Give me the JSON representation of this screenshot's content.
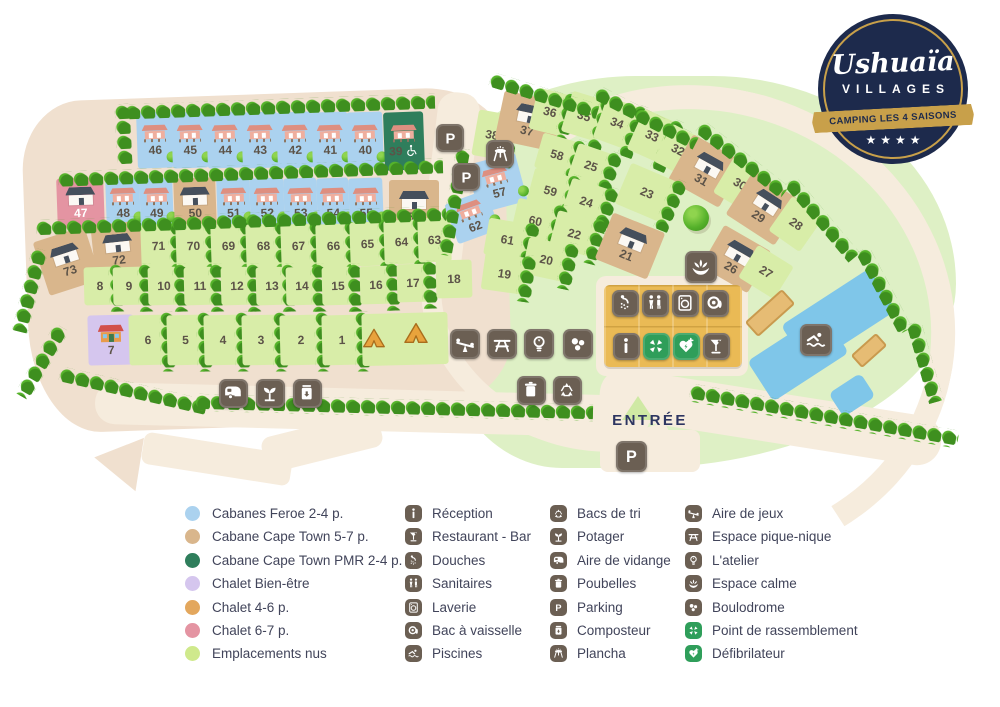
{
  "logo": {
    "brand": "Ushuaïa",
    "sub": "VILLAGES",
    "banner": "CAMPING LES 4 SAISONS",
    "stars": "★★★★"
  },
  "map": {
    "entrance_label": "ENTRÉE",
    "pitches": [
      {
        "n": "46",
        "x": 137,
        "y": 112,
        "w": 36,
        "h": 56,
        "r": -2,
        "t": "b",
        "c": "s"
      },
      {
        "n": "45",
        "x": 172,
        "y": 112,
        "w": 36,
        "h": 56,
        "r": -2,
        "t": "b",
        "c": "s"
      },
      {
        "n": "44",
        "x": 207,
        "y": 112,
        "w": 36,
        "h": 56,
        "r": -2,
        "t": "b",
        "c": "s"
      },
      {
        "n": "43",
        "x": 242,
        "y": 112,
        "w": 36,
        "h": 56,
        "r": -2,
        "t": "b",
        "c": "s"
      },
      {
        "n": "42",
        "x": 277,
        "y": 112,
        "w": 36,
        "h": 56,
        "r": -2,
        "t": "b",
        "c": "s"
      },
      {
        "n": "41",
        "x": 312,
        "y": 112,
        "w": 36,
        "h": 56,
        "r": -2,
        "t": "b",
        "c": "s"
      },
      {
        "n": "40",
        "x": 347,
        "y": 112,
        "w": 36,
        "h": 56,
        "r": -2,
        "t": "b",
        "c": "s"
      },
      {
        "n": "39",
        "x": 384,
        "y": 112,
        "w": 40,
        "h": 58,
        "r": -2,
        "t": "d",
        "c": "s",
        "pw": true
      },
      {
        "n": "47",
        "x": 57,
        "y": 178,
        "w": 47,
        "h": 50,
        "r": -2,
        "t": "p",
        "c": "h",
        "wl": true
      },
      {
        "n": "48",
        "x": 106,
        "y": 178,
        "w": 34,
        "h": 50,
        "r": -2,
        "t": "b",
        "c": "s"
      },
      {
        "n": "49",
        "x": 140,
        "y": 178,
        "w": 33,
        "h": 50,
        "r": -2,
        "t": "b",
        "c": "s"
      },
      {
        "n": "50",
        "x": 174,
        "y": 178,
        "w": 42,
        "h": 50,
        "r": -2,
        "t": "t",
        "c": "h"
      },
      {
        "n": "51",
        "x": 217,
        "y": 178,
        "w": 33,
        "h": 50,
        "r": -2,
        "t": "b",
        "c": "s"
      },
      {
        "n": "52",
        "x": 250,
        "y": 178,
        "w": 34,
        "h": 50,
        "r": -2,
        "t": "b",
        "c": "s"
      },
      {
        "n": "53",
        "x": 284,
        "y": 178,
        "w": 33,
        "h": 50,
        "r": -2,
        "t": "b",
        "c": "s"
      },
      {
        "n": "54",
        "x": 317,
        "y": 178,
        "w": 32,
        "h": 50,
        "r": -2,
        "t": "b",
        "c": "s"
      },
      {
        "n": "55",
        "x": 349,
        "y": 178,
        "w": 34,
        "h": 50,
        "r": -2,
        "t": "b",
        "c": "s"
      },
      {
        "n": "56",
        "x": 389,
        "y": 180,
        "w": 50,
        "h": 54,
        "r": 0,
        "t": "t",
        "c": "h"
      },
      {
        "n": "57",
        "x": 472,
        "y": 158,
        "w": 50,
        "h": 50,
        "r": -15,
        "t": "b",
        "c": "s"
      },
      {
        "n": "62",
        "x": 450,
        "y": 196,
        "w": 44,
        "h": 42,
        "r": -20,
        "t": "b",
        "c": "s"
      },
      {
        "n": "73",
        "x": 40,
        "y": 233,
        "w": 54,
        "h": 56,
        "r": -18,
        "t": "t",
        "c": "h"
      },
      {
        "n": "72",
        "x": 93,
        "y": 223,
        "w": 50,
        "h": 54,
        "r": -6,
        "t": "t",
        "c": "h"
      },
      {
        "n": "71",
        "x": 141,
        "y": 224,
        "w": 35,
        "h": 44,
        "r": -2,
        "t": "g",
        "s": true
      },
      {
        "n": "70",
        "x": 176,
        "y": 224,
        "w": 35,
        "h": 44,
        "r": -2,
        "t": "g",
        "s": true
      },
      {
        "n": "69",
        "x": 211,
        "y": 224,
        "w": 35,
        "h": 44,
        "r": -2,
        "t": "g",
        "s": true
      },
      {
        "n": "68",
        "x": 246,
        "y": 224,
        "w": 35,
        "h": 44,
        "r": -2,
        "t": "g",
        "s": true
      },
      {
        "n": "67",
        "x": 281,
        "y": 224,
        "w": 35,
        "h": 44,
        "r": -2,
        "t": "g",
        "s": true
      },
      {
        "n": "66",
        "x": 316,
        "y": 224,
        "w": 35,
        "h": 44,
        "r": -2,
        "t": "g",
        "s": true
      },
      {
        "n": "65",
        "x": 350,
        "y": 222,
        "w": 35,
        "h": 44,
        "r": -2,
        "t": "g",
        "s": true
      },
      {
        "n": "64",
        "x": 384,
        "y": 220,
        "w": 35,
        "h": 44,
        "r": -2,
        "t": "g",
        "s": true
      },
      {
        "n": "63",
        "x": 418,
        "y": 218,
        "w": 33,
        "h": 44,
        "r": -2,
        "t": "g"
      },
      {
        "n": "8",
        "x": 84,
        "y": 267,
        "w": 32,
        "h": 38,
        "r": -1.5,
        "t": "g",
        "s": true
      },
      {
        "n": "9",
        "x": 113,
        "y": 267,
        "w": 32,
        "h": 38,
        "r": -1.5,
        "t": "g",
        "s": true
      },
      {
        "n": "10",
        "x": 148,
        "y": 267,
        "w": 32,
        "h": 38,
        "r": -1.5,
        "t": "g",
        "s": true
      },
      {
        "n": "11",
        "x": 184,
        "y": 267,
        "w": 32,
        "h": 38,
        "r": -1.5,
        "t": "g",
        "s": true
      },
      {
        "n": "12",
        "x": 221,
        "y": 267,
        "w": 32,
        "h": 38,
        "r": -1.5,
        "t": "g",
        "s": true
      },
      {
        "n": "13",
        "x": 256,
        "y": 267,
        "w": 32,
        "h": 38,
        "r": -1.5,
        "t": "g",
        "s": true
      },
      {
        "n": "14",
        "x": 286,
        "y": 267,
        "w": 32,
        "h": 38,
        "r": -1.5,
        "t": "g",
        "s": true
      },
      {
        "n": "15",
        "x": 322,
        "y": 267,
        "w": 32,
        "h": 38,
        "r": -1.5,
        "t": "g",
        "s": true
      },
      {
        "n": "16",
        "x": 360,
        "y": 266,
        "w": 32,
        "h": 38,
        "r": -1.5,
        "t": "g",
        "s": true
      },
      {
        "n": "17",
        "x": 397,
        "y": 264,
        "w": 32,
        "h": 38,
        "r": -1.5,
        "t": "g",
        "s": true
      },
      {
        "n": "18",
        "x": 436,
        "y": 260,
        "w": 36,
        "h": 38,
        "r": -1.5,
        "t": "g"
      },
      {
        "n": "7",
        "x": 88,
        "y": 315,
        "w": 46,
        "h": 50,
        "r": -1.5,
        "t": "v",
        "c": "c"
      },
      {
        "n": "6",
        "x": 129,
        "y": 315,
        "w": 38,
        "h": 50,
        "r": -1.5,
        "t": "g",
        "s": true
      },
      {
        "n": "5",
        "x": 167,
        "y": 315,
        "w": 37,
        "h": 50,
        "r": -1.5,
        "t": "g",
        "s": true
      },
      {
        "n": "4",
        "x": 204,
        "y": 315,
        "w": 38,
        "h": 50,
        "r": -1.5,
        "t": "g",
        "s": true
      },
      {
        "n": "3",
        "x": 242,
        "y": 315,
        "w": 38,
        "h": 50,
        "r": -1.5,
        "t": "g",
        "s": true
      },
      {
        "n": "2",
        "x": 280,
        "y": 315,
        "w": 42,
        "h": 50,
        "r": -1.5,
        "t": "g",
        "s": true
      },
      {
        "n": "1",
        "x": 322,
        "y": 315,
        "w": 40,
        "h": 50,
        "r": -1.5,
        "t": "g",
        "s": true
      },
      {
        "n": "",
        "x": 362,
        "y": 313,
        "w": 86,
        "h": 52,
        "r": -1.5,
        "t": "g"
      },
      {
        "n": "38",
        "x": 475,
        "y": 112,
        "w": 34,
        "h": 46,
        "r": 10,
        "t": "g",
        "s": true
      },
      {
        "n": "37",
        "x": 499,
        "y": 96,
        "w": 60,
        "h": 50,
        "r": 12,
        "t": "t",
        "c": "h"
      },
      {
        "n": "36",
        "x": 533,
        "y": 91,
        "w": 34,
        "h": 42,
        "r": 14,
        "t": "g",
        "s": true
      },
      {
        "n": "35",
        "x": 566,
        "y": 95,
        "w": 36,
        "h": 42,
        "r": 17,
        "t": "g",
        "s": true
      },
      {
        "n": "34",
        "x": 599,
        "y": 101,
        "w": 36,
        "h": 44,
        "r": 20,
        "t": "g",
        "s": true
      },
      {
        "n": "33",
        "x": 634,
        "y": 114,
        "w": 36,
        "h": 44,
        "r": 24,
        "t": "g",
        "s": true
      },
      {
        "n": "32",
        "x": 661,
        "y": 129,
        "w": 34,
        "h": 42,
        "r": 27,
        "t": "g"
      },
      {
        "n": "31",
        "x": 677,
        "y": 145,
        "w": 58,
        "h": 52,
        "r": 29,
        "t": "t",
        "c": "h"
      },
      {
        "n": "30",
        "x": 721,
        "y": 163,
        "w": 38,
        "h": 42,
        "r": 31,
        "t": "g"
      },
      {
        "n": "29",
        "x": 735,
        "y": 182,
        "w": 58,
        "h": 52,
        "r": 33,
        "t": "t",
        "c": "h"
      },
      {
        "n": "28",
        "x": 777,
        "y": 203,
        "w": 38,
        "h": 42,
        "r": 35,
        "t": "g"
      },
      {
        "n": "58",
        "x": 538,
        "y": 137,
        "w": 38,
        "h": 36,
        "r": 16,
        "t": "g",
        "s": true
      },
      {
        "n": "25",
        "x": 572,
        "y": 148,
        "w": 38,
        "h": 36,
        "r": 19,
        "t": "g",
        "s": true
      },
      {
        "n": "59",
        "x": 530,
        "y": 172,
        "w": 41,
        "h": 37,
        "r": 15,
        "t": "g",
        "s": true
      },
      {
        "n": "24",
        "x": 566,
        "y": 183,
        "w": 41,
        "h": 37,
        "r": 18,
        "t": "g",
        "s": true
      },
      {
        "n": "23",
        "x": 621,
        "y": 171,
        "w": 52,
        "h": 44,
        "r": 23,
        "t": "g",
        "s": true
      },
      {
        "n": "60",
        "x": 514,
        "y": 202,
        "w": 43,
        "h": 37,
        "r": 13,
        "t": "g",
        "s": true
      },
      {
        "n": "22",
        "x": 553,
        "y": 215,
        "w": 43,
        "h": 37,
        "r": 15,
        "t": "g",
        "s": true
      },
      {
        "n": "61",
        "x": 486,
        "y": 221,
        "w": 43,
        "h": 37,
        "r": 10,
        "t": "g",
        "s": true
      },
      {
        "n": "20",
        "x": 525,
        "y": 241,
        "w": 43,
        "h": 37,
        "r": 12,
        "t": "g",
        "s": true
      },
      {
        "n": "19",
        "x": 483,
        "y": 255,
        "w": 43,
        "h": 37,
        "r": 8,
        "t": "g",
        "s": true
      },
      {
        "n": "21",
        "x": 602,
        "y": 221,
        "w": 56,
        "h": 50,
        "r": 22,
        "t": "t",
        "c": "h"
      },
      {
        "n": "26",
        "x": 709,
        "y": 235,
        "w": 54,
        "h": 48,
        "r": 30,
        "t": "t",
        "c": "h"
      },
      {
        "n": "27",
        "x": 745,
        "y": 253,
        "w": 42,
        "h": 38,
        "r": 32,
        "t": "g"
      }
    ],
    "icons": [
      {
        "i": "parking",
        "x": 450,
        "y": 138,
        "s": 28
      },
      {
        "i": "parking",
        "x": 466,
        "y": 177,
        "s": 28
      },
      {
        "i": "grill",
        "x": 500,
        "y": 154,
        "s": 28
      },
      {
        "i": "shower",
        "x": 625,
        "y": 303,
        "s": 27
      },
      {
        "i": "wc",
        "x": 655,
        "y": 303,
        "s": 27
      },
      {
        "i": "laundry",
        "x": 685,
        "y": 303,
        "s": 27
      },
      {
        "i": "dishes",
        "x": 715,
        "y": 303,
        "s": 27
      },
      {
        "i": "info",
        "x": 626,
        "y": 346,
        "s": 27
      },
      {
        "i": "assembly",
        "x": 656,
        "y": 346,
        "s": 27,
        "green": true
      },
      {
        "i": "defib",
        "x": 686,
        "y": 346,
        "s": 27,
        "green": true
      },
      {
        "i": "cocktail",
        "x": 716,
        "y": 346,
        "s": 27
      },
      {
        "i": "lotus",
        "x": 701,
        "y": 267,
        "s": 32
      },
      {
        "i": "swim",
        "x": 816,
        "y": 340,
        "s": 32
      },
      {
        "i": "seesaw",
        "x": 465,
        "y": 344,
        "s": 30
      },
      {
        "i": "picnic",
        "x": 502,
        "y": 344,
        "s": 30
      },
      {
        "i": "bulb",
        "x": 539,
        "y": 344,
        "s": 30
      },
      {
        "i": "boules",
        "x": 578,
        "y": 344,
        "s": 30
      },
      {
        "i": "trash",
        "x": 531,
        "y": 390,
        "s": 29
      },
      {
        "i": "recycle",
        "x": 567,
        "y": 390,
        "s": 29
      },
      {
        "i": "caravan",
        "x": 233,
        "y": 393,
        "s": 29
      },
      {
        "i": "sprout",
        "x": 270,
        "y": 393,
        "s": 29
      },
      {
        "i": "compost",
        "x": 307,
        "y": 393,
        "s": 29
      },
      {
        "i": "parking",
        "x": 631,
        "y": 456,
        "s": 31
      },
      {
        "i": "tent",
        "x": 374,
        "y": 338,
        "s": 26,
        "plain": true
      },
      {
        "i": "tent",
        "x": 416,
        "y": 333,
        "s": 28,
        "plain": true
      }
    ]
  },
  "legend": {
    "plots": [
      {
        "label": "Cabanes Feroe 2-4 p.",
        "color": "#abd2ef"
      },
      {
        "label": "Cabane Cape Town 5-7 p.",
        "color": "#d9b68c"
      },
      {
        "label": "Cabane Cape Town PMR 2-4 p.",
        "color": "#2f7e5c"
      },
      {
        "label": "Chalet Bien-être",
        "color": "#d5c6ee"
      },
      {
        "label": "Chalet 4-6 p.",
        "color": "#e3a75d"
      },
      {
        "label": "Chalet 6-7 p.",
        "color": "#e494a2"
      },
      {
        "label": "Emplacements nus",
        "color": "#cfe98c"
      }
    ],
    "facilities": [
      [
        {
          "icon": "info",
          "label": "Réception"
        },
        {
          "icon": "cocktail",
          "label": "Restaurant - Bar"
        },
        {
          "icon": "shower",
          "label": "Douches"
        },
        {
          "icon": "wc",
          "label": "Sanitaires"
        },
        {
          "icon": "laundry",
          "label": "Laverie"
        },
        {
          "icon": "dishes",
          "label": "Bac à vaisselle"
        },
        {
          "icon": "swim",
          "label": "Piscines"
        }
      ],
      [
        {
          "icon": "recycle",
          "label": "Bacs de tri"
        },
        {
          "icon": "sprout",
          "label": "Potager"
        },
        {
          "icon": "caravan",
          "label": "Aire de vidange"
        },
        {
          "icon": "trash",
          "label": "Poubelles"
        },
        {
          "icon": "parking",
          "label": "Parking"
        },
        {
          "icon": "compost",
          "label": "Composteur"
        },
        {
          "icon": "grill",
          "label": "Plancha"
        }
      ],
      [
        {
          "icon": "seesaw",
          "label": "Aire de jeux"
        },
        {
          "icon": "picnic",
          "label": "Espace pique-nique"
        },
        {
          "icon": "bulb",
          "label": "L'atelier"
        },
        {
          "icon": "lotus",
          "label": "Espace calme"
        },
        {
          "icon": "boules",
          "label": "Boulodrome"
        },
        {
          "icon": "assembly",
          "label": "Point de rassemblement",
          "green": true
        },
        {
          "icon": "defib",
          "label": "Défibrilateur",
          "green": true
        }
      ]
    ]
  }
}
